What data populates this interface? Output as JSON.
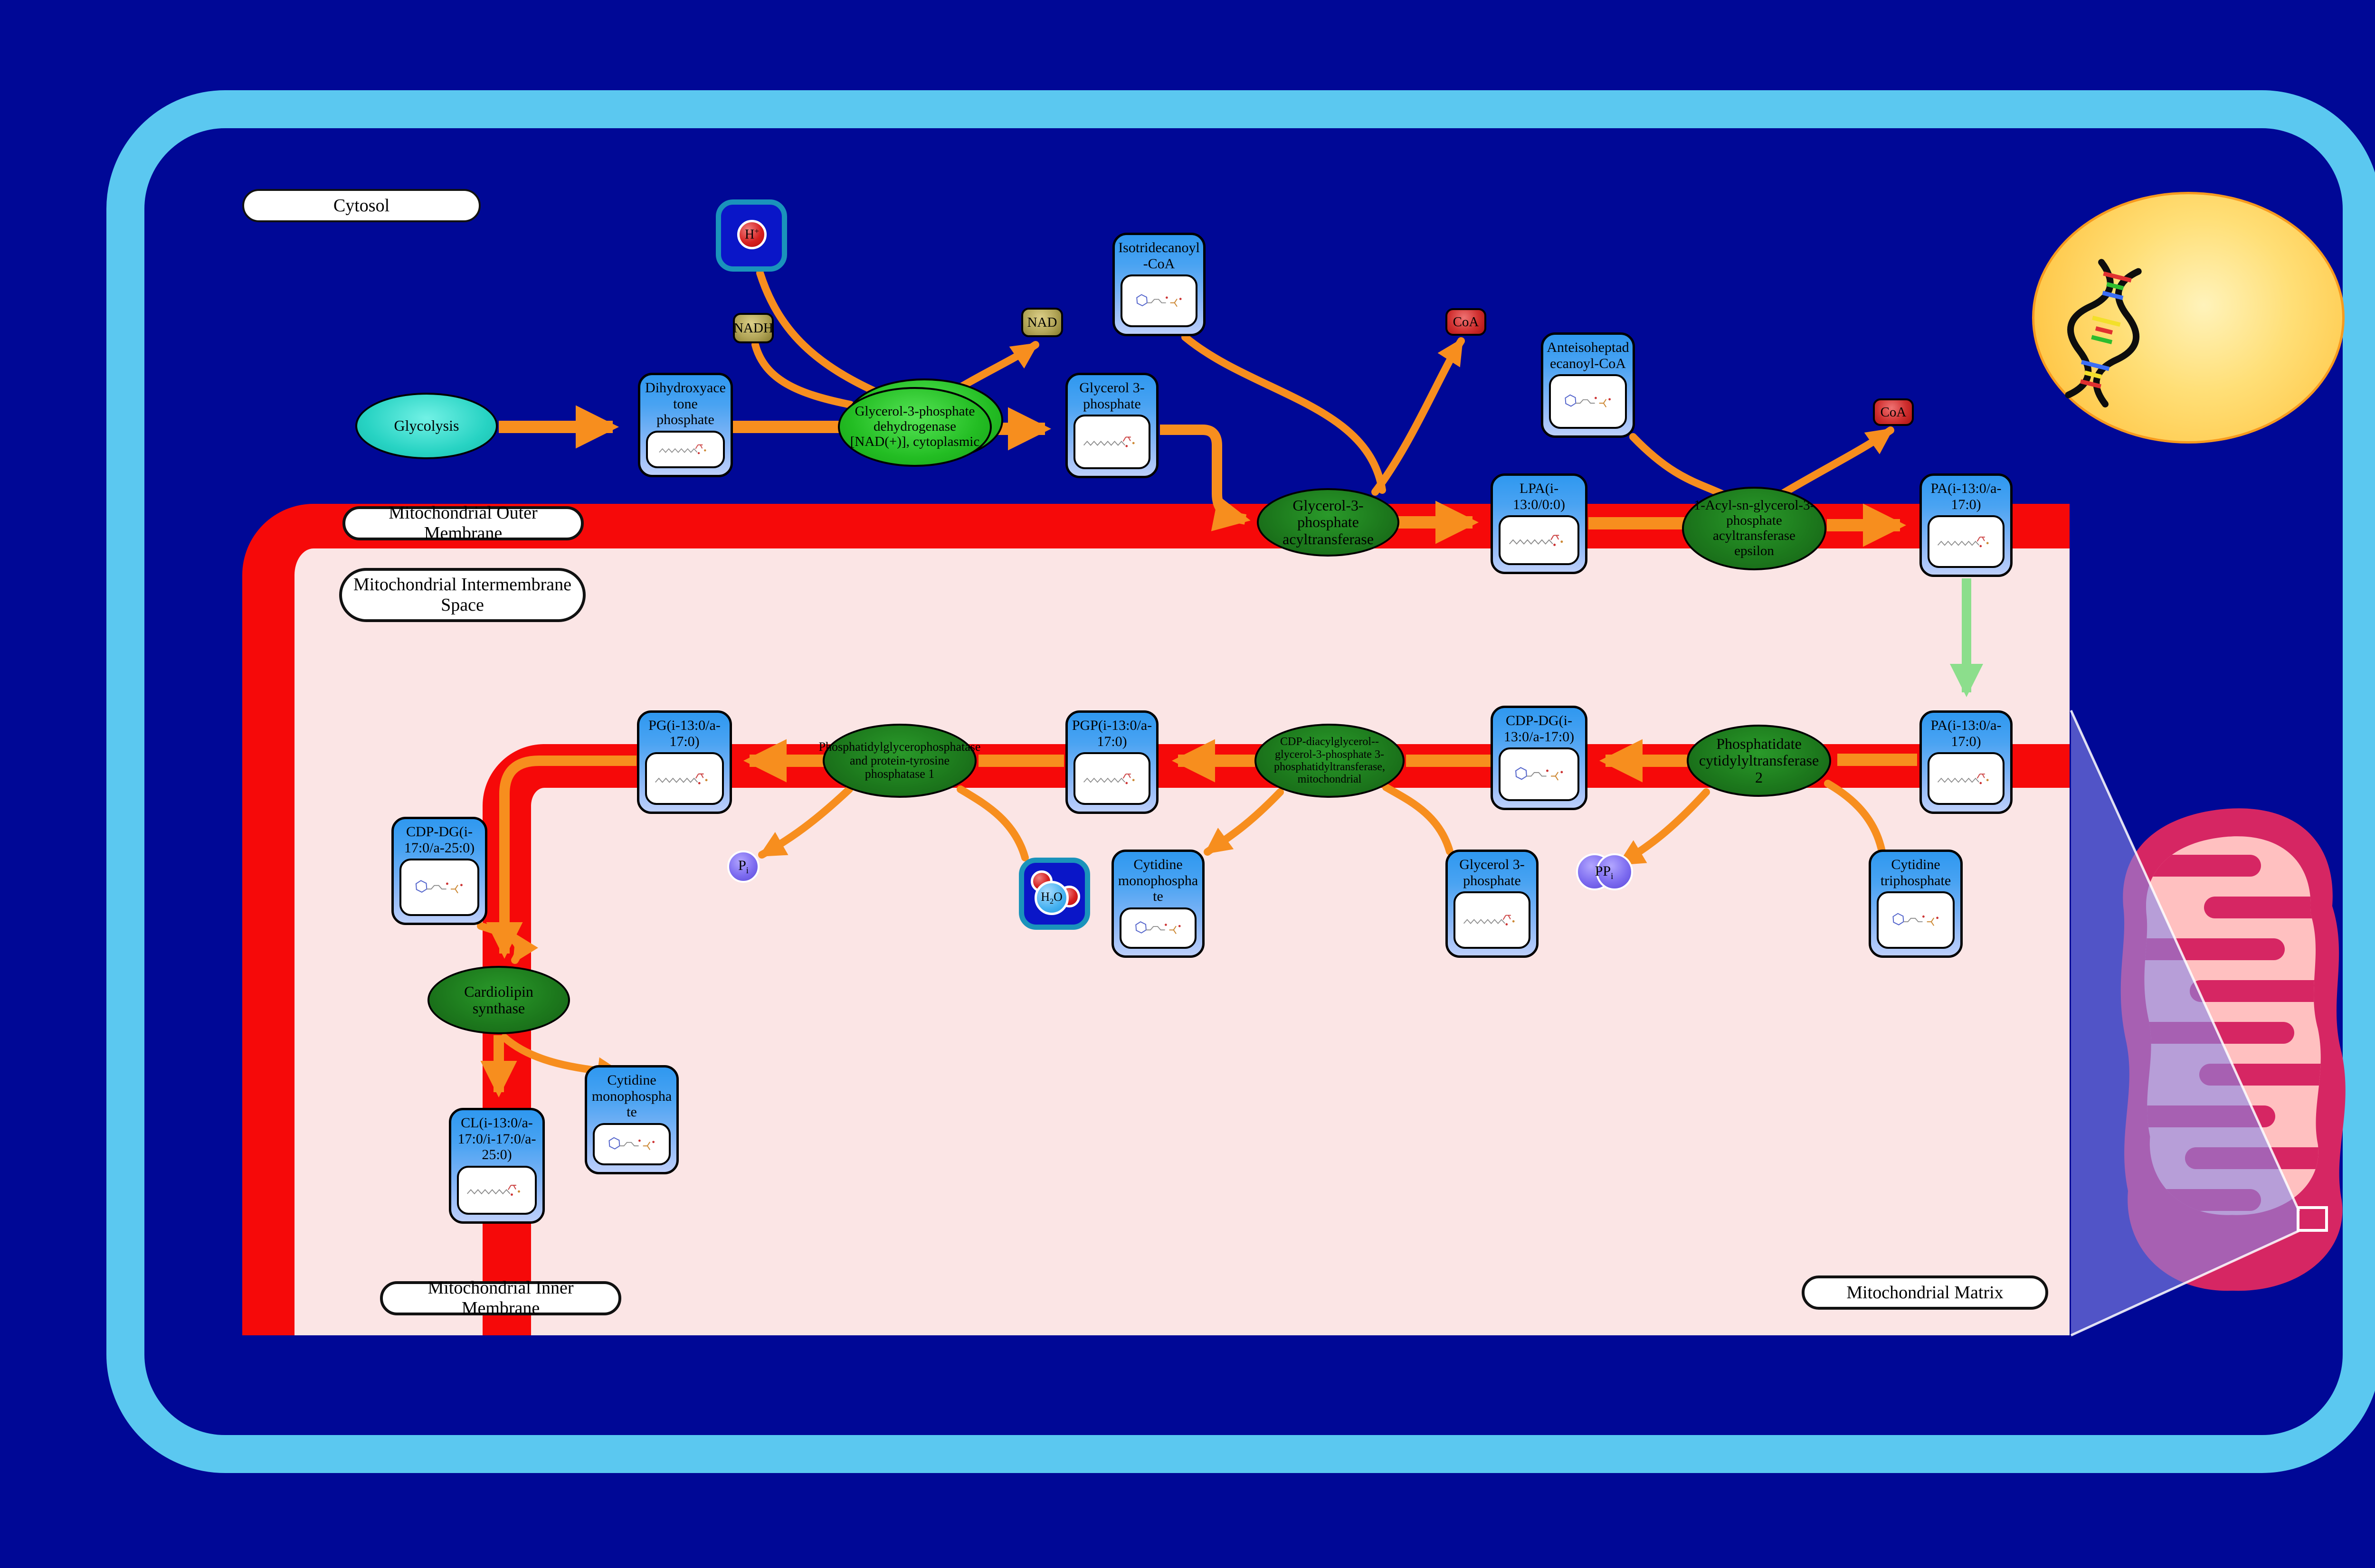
{
  "labels": {
    "cytosol": "Cytosol",
    "outer_membrane": "Mitochondrial Outer Membrane",
    "intermembrane_space": "Mitochondrial Intermembrane Space",
    "inner_membrane": "Mitochondrial Inner Membrane",
    "matrix": "Mitochondrial Matrix"
  },
  "pathway_node": {
    "glycolysis": "Glycolysis"
  },
  "metabolites": {
    "dhap": "Dihydroxyacetone phosphate",
    "g3p_cytosol": "Glycerol 3-phosphate",
    "itd_coa": "Isotridecanoyl-CoA",
    "ahd_coa": "Anteisoheptadecanoyl-CoA",
    "lpa": "LPA(i-13:0/0:0)",
    "pa_outer": "PA(i-13:0/a-17:0)",
    "pa_inner": "PA(i-13:0/a-17:0)",
    "cdp_dg_inner": "CDP-DG(i-13:0/a-17:0)",
    "pgp": "PGP(i-13:0/a-17:0)",
    "pg": "PG(i-13:0/a-17:0)",
    "cmp_mid": "Cytidine monophosphate",
    "g3p_matrix": "Glycerol 3-phosphate",
    "ctp": "Cytidine triphosphate",
    "cdp_dg_left": "CDP-DG(i-17:0/a-25:0)",
    "cl": "CL(i-13:0/a-17:0/i-17:0/a-25:0)",
    "cmp_left": "Cytidine monophosphate"
  },
  "enzymes": {
    "gpd": "Glycerol-3-phosphate dehydrogenase [NAD(+)], cytoplasmic",
    "gpat": "Glycerol-3-phosphate acyltransferase",
    "agpat": "1-Acyl-sn-glycerol-3-phosphate acyltransferase epsilon",
    "cds": "Phosphatidate cytidylyltransferase 2",
    "pgps": "CDP-diacylglycerol--glycerol-3-phosphate 3-phosphatidyltransferase, mitochondrial",
    "ptpmt": "Phosphatidylglycerophosphatase and protein-tyrosine phosphatase 1",
    "crls": "Cardiolipin synthase"
  },
  "cofactors": {
    "nadh": "NADH",
    "nad": "NAD",
    "coa_1": "CoA",
    "coa_2": "CoA",
    "hplus": {
      "base": "H",
      "sup": "+"
    },
    "h2o": {
      "h": "H",
      "sub": "2",
      "o": "O"
    },
    "pi": {
      "base": "P",
      "sub": "i"
    },
    "ppi": {
      "base": "PP",
      "sub": "i"
    }
  },
  "colors": {
    "background_navy": "#000896",
    "cell_wall_blue": "#5bc8f0",
    "membrane_red": "#f60909",
    "interior_pink": "#fbe5e5",
    "arrow_orange": "#f78e1e",
    "transport_green": "#8cde8c",
    "box_blue": "#2f98f0",
    "enzyme_green_dark": "#1d7a1d",
    "enzyme_green_bright": "#23bd23",
    "glycolysis_turquoise": "#27d3c3",
    "nucleus_gold": "#ffbb30",
    "mitochondrion_crimson": "#d62663",
    "mitochondrion_pink": "#ffc0c0"
  }
}
